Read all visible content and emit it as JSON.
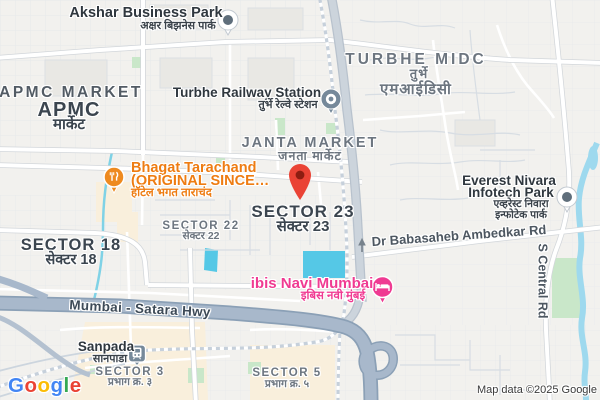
{
  "attribution": "Map data ©2025 Google",
  "logo": {
    "g1": "G",
    "o1": "o",
    "o2": "o",
    "g2": "g",
    "l1": "l",
    "e1": "e"
  },
  "places": {
    "akshar": {
      "en": "Akshar Business Park",
      "hi": "अक्षर बिझनेस पार्क"
    },
    "turbhe_midc": {
      "en": "TURBHE MIDC",
      "hi1": "तुर्भे",
      "hi2": "एमआईडिसी"
    },
    "apmc": {
      "area": "APMC MARKET",
      "en": "APMC",
      "hi": "मार्केट"
    },
    "turbhe_station": {
      "en": "Turbhe Railway Station",
      "hi": "तुर्भे रेल्वे स्टेशन"
    },
    "janta": {
      "en": "JANTA MARKET",
      "hi": "जनता मार्केट"
    },
    "bhagat": {
      "line1": "Bhagat Tarachand",
      "line2": "(ORIGINAL SINCE…",
      "hi": "हॉटेल भगत ताराचंद"
    },
    "sector23": {
      "en": "SECTOR 23",
      "hi": "सेक्टर 23"
    },
    "sector22": {
      "en": "SECTOR 22",
      "hi": "सेक्टर 22"
    },
    "sector18": {
      "en": "SECTOR 18",
      "hi": "सेक्टर 18"
    },
    "everest": {
      "en1": "Everest Nivara",
      "en2": "Infotech Park",
      "hi1": "एव्हरेस्ट निवारा",
      "hi2": "इन्फोटेक पार्क"
    },
    "ibis": {
      "en": "ibis Navi Mumbai",
      "hi": "इबिस नवी मुंबई"
    },
    "sanpada": {
      "en": "Sanpada",
      "hi": "सानपाडा"
    },
    "sector3": {
      "en": "SECTOR 3",
      "hi": "प्रभाग क्र. ३"
    },
    "sector5": {
      "en": "SECTOR 5",
      "hi": "प्रभाग क्र. ५"
    }
  },
  "roads": {
    "hwy": "Mumbai - Satara Hwy",
    "ambedkar": "Dr Babasaheb Ambedkar Rd",
    "central": "S Central Rd"
  },
  "icons": {
    "akshar_marker": "white-dot-circle-icon",
    "everest_marker": "white-dot-circle-icon",
    "turbhe_station_marker": "transit-station-pin-icon",
    "sanpada_marker": "train-icon",
    "bhagat_marker": "restaurant-fork-knife-icon",
    "ibis_marker": "hotel-bed-icon",
    "destination": "red-map-pin-icon"
  },
  "colors": {
    "land": "#f2f1ee",
    "highway": "#a8b8cb",
    "highway_casing": "#8ba0b6",
    "water": "#55c8e6",
    "stream": "#9ed9ee",
    "park": "#c9e7c9",
    "commercial_area": "#f9efdc",
    "pin_red": "#EA4335",
    "restaurant_orange": "#ee8a1f",
    "hotel_pink": "#ef3a92",
    "transit_slate": "#76899a"
  }
}
